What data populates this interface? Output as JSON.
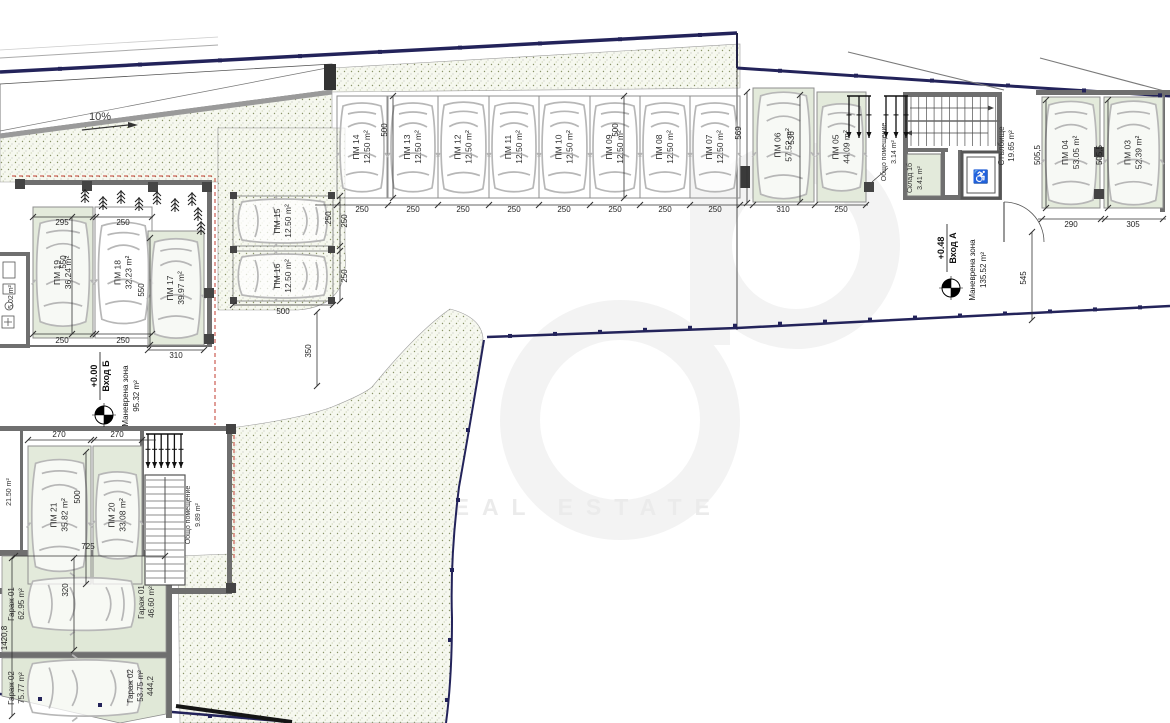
{
  "colors": {
    "stall_green": "#e3eadb",
    "stipple_bg": "#f6f8ef",
    "wall_gray": "#6f6f6f",
    "property_navy": "#23235a",
    "overhang_red": "#c23b2f",
    "car_gray": "#b7b7b7"
  },
  "ramp": {
    "slope": "10%"
  },
  "watermark": {
    "line1": "REAL ESTATE"
  },
  "icons": {
    "wheelchair": "♿"
  },
  "entrance_b": {
    "level": "+0.00",
    "name": "Вход Б",
    "zone": "Маневрена зона",
    "zone_area": "95.32 m²"
  },
  "entrance_a": {
    "level": "+0.48",
    "name": "Вход А",
    "zone": "Маневрена зона",
    "zone_area": "135.52 m²"
  },
  "stalls": [
    {
      "id": "ПМ 14",
      "area": "12.50 m²",
      "x": 337,
      "y": 96,
      "w": 50,
      "h": 102,
      "o": "v",
      "g": false
    },
    {
      "id": "ПМ 13",
      "area": "12.50 m²",
      "x": 388,
      "y": 96,
      "w": 50,
      "h": 102,
      "o": "v",
      "g": false
    },
    {
      "id": "ПМ 12",
      "area": "12.50 m²",
      "x": 438,
      "y": 96,
      "w": 51,
      "h": 102,
      "o": "v",
      "g": false
    },
    {
      "id": "ПМ 11",
      "area": "12.50 m²",
      "x": 489,
      "y": 96,
      "w": 50,
      "h": 102,
      "o": "v",
      "g": false
    },
    {
      "id": "ПМ 10",
      "area": "12.50 m²",
      "x": 539,
      "y": 96,
      "w": 51,
      "h": 102,
      "o": "v",
      "g": false
    },
    {
      "id": "ПМ 09",
      "area": "12.50 m²",
      "x": 590,
      "y": 96,
      "w": 50,
      "h": 102,
      "o": "v",
      "g": false
    },
    {
      "id": "ПМ 08",
      "area": "12.50 m²",
      "x": 640,
      "y": 96,
      "w": 50,
      "h": 102,
      "o": "v",
      "g": false
    },
    {
      "id": "ПМ 07",
      "area": "12.50 m²",
      "x": 690,
      "y": 96,
      "w": 50,
      "h": 102,
      "o": "v",
      "g": false
    },
    {
      "id": "ПМ 06",
      "area": "57.52 m²",
      "x": 753,
      "y": 88,
      "w": 61,
      "h": 114,
      "o": "v",
      "g": true
    },
    {
      "id": "ПМ 05",
      "area": "44.09 m²",
      "x": 817,
      "y": 92,
      "w": 49,
      "h": 110,
      "o": "v",
      "g": true
    },
    {
      "id": "ПМ 04",
      "area": "53.05 m²",
      "x": 1042,
      "y": 97,
      "w": 58,
      "h": 111,
      "o": "v",
      "g": true
    },
    {
      "id": "ПМ 03",
      "area": "52.39 m²",
      "x": 1104,
      "y": 97,
      "w": 59,
      "h": 111,
      "o": "v",
      "g": true
    },
    {
      "id": "ПМ 19",
      "area": "36.24 m²",
      "x": 33,
      "y": 207,
      "w": 60,
      "h": 131,
      "o": "v",
      "g": true
    },
    {
      "id": "ПМ 18",
      "area": "32.23 m²",
      "x": 95,
      "y": 207,
      "w": 57,
      "h": 131,
      "o": "v",
      "g": false
    },
    {
      "id": "ПМ 17",
      "area": "39.97 m²",
      "x": 148,
      "y": 231,
      "w": 56,
      "h": 114,
      "o": "v",
      "g": true
    },
    {
      "id": "ПМ 15",
      "area": "12.50 m²",
      "x": 233,
      "y": 196,
      "w": 100,
      "h": 50,
      "o": "h",
      "g": false
    },
    {
      "id": "ПМ 16",
      "area": "12.50 m²",
      "x": 233,
      "y": 251,
      "w": 100,
      "h": 50,
      "o": "h",
      "g": false
    },
    {
      "id": "ПМ 21",
      "area": "35.82 m²",
      "x": 28,
      "y": 446,
      "w": 63,
      "h": 138,
      "o": "v",
      "g": true
    },
    {
      "id": "ПМ 20",
      "area": "33.08 m²",
      "x": 93,
      "y": 446,
      "w": 49,
      "h": 138,
      "o": "v",
      "g": true
    }
  ],
  "labels": [
    {
      "lines": [
        "Стълбище",
        "19.65 m²"
      ],
      "x": 1006,
      "y": 146,
      "fs": 8
    },
    {
      "lines": [
        "Склад 1б",
        "3.41 m²"
      ],
      "x": 914,
      "y": 178,
      "fs": 7
    },
    {
      "lines": [
        "Общо помещение",
        "3.14 m²"
      ],
      "x": 888,
      "y": 152,
      "fs": 7
    },
    {
      "lines": [
        "Общо помещение",
        "9.89 m²"
      ],
      "x": 192,
      "y": 515,
      "fs": 7
    },
    {
      "lines": [
        "5.02 m²"
      ],
      "x": 10,
      "y": 297,
      "fs": 7
    },
    {
      "lines": [
        "21.50 m²"
      ],
      "x": 8,
      "y": 492,
      "fs": 7
    },
    {
      "lines": [
        "Гараж 01",
        "62.95 m²"
      ],
      "x": 16,
      "y": 604,
      "fs": 8
    },
    {
      "lines": [
        "Гараж 01",
        "46.60 m²"
      ],
      "x": 146,
      "y": 602,
      "fs": 8
    },
    {
      "lines": [
        "Гараж 02",
        "75.77 m²"
      ],
      "x": 16,
      "y": 688,
      "fs": 8
    },
    {
      "lines": [
        "Гараж 02",
        "53.75 m²",
        "444,2"
      ],
      "x": 140,
      "y": 686,
      "fs": 8
    }
  ],
  "dims": [
    {
      "t": "250",
      "x": 362,
      "y": 212
    },
    {
      "t": "250",
      "x": 413,
      "y": 212
    },
    {
      "t": "250",
      "x": 463,
      "y": 212
    },
    {
      "t": "250",
      "x": 514,
      "y": 212
    },
    {
      "t": "250",
      "x": 564,
      "y": 212
    },
    {
      "t": "250",
      "x": 615,
      "y": 212
    },
    {
      "t": "250",
      "x": 665,
      "y": 212
    },
    {
      "t": "250",
      "x": 715,
      "y": 212
    },
    {
      "t": "250",
      "x": 331,
      "y": 218,
      "r": -90
    },
    {
      "t": "500",
      "x": 387,
      "y": 130,
      "r": -90
    },
    {
      "t": "500",
      "x": 618,
      "y": 130,
      "r": -90
    },
    {
      "t": "569",
      "x": 741,
      "y": 133,
      "r": -90
    },
    {
      "t": "536",
      "x": 794,
      "y": 138,
      "r": -90
    },
    {
      "t": "310",
      "x": 783,
      "y": 212
    },
    {
      "t": "250",
      "x": 841,
      "y": 212
    },
    {
      "t": "505,5",
      "x": 1040,
      "y": 155,
      "r": -90
    },
    {
      "t": "505,5",
      "x": 1102,
      "y": 155,
      "r": -90
    },
    {
      "t": "290",
      "x": 1071,
      "y": 227
    },
    {
      "t": "305",
      "x": 1133,
      "y": 227
    },
    {
      "t": "545",
      "x": 1026,
      "y": 278,
      "r": -90
    },
    {
      "t": "295",
      "x": 62,
      "y": 225
    },
    {
      "t": "250",
      "x": 123,
      "y": 225
    },
    {
      "t": "250",
      "x": 62,
      "y": 343
    },
    {
      "t": "250",
      "x": 123,
      "y": 343
    },
    {
      "t": "550",
      "x": 66,
      "y": 262,
      "r": -90
    },
    {
      "t": "550",
      "x": 144,
      "y": 290,
      "r": -90
    },
    {
      "t": "310",
      "x": 176,
      "y": 358
    },
    {
      "t": "250",
      "x": 347,
      "y": 221,
      "r": -90
    },
    {
      "t": "250",
      "x": 347,
      "y": 276,
      "r": -90
    },
    {
      "t": "500",
      "x": 283,
      "y": 314
    },
    {
      "t": "350",
      "x": 311,
      "y": 351,
      "r": -90
    },
    {
      "t": "270",
      "x": 59,
      "y": 437
    },
    {
      "t": "270",
      "x": 117,
      "y": 437
    },
    {
      "t": "500",
      "x": 80,
      "y": 497,
      "r": -90
    },
    {
      "t": "725",
      "x": 88,
      "y": 549
    },
    {
      "t": "320",
      "x": 68,
      "y": 590,
      "r": -90
    },
    {
      "t": "1420,8",
      "x": 7,
      "y": 638,
      "r": -90
    }
  ]
}
